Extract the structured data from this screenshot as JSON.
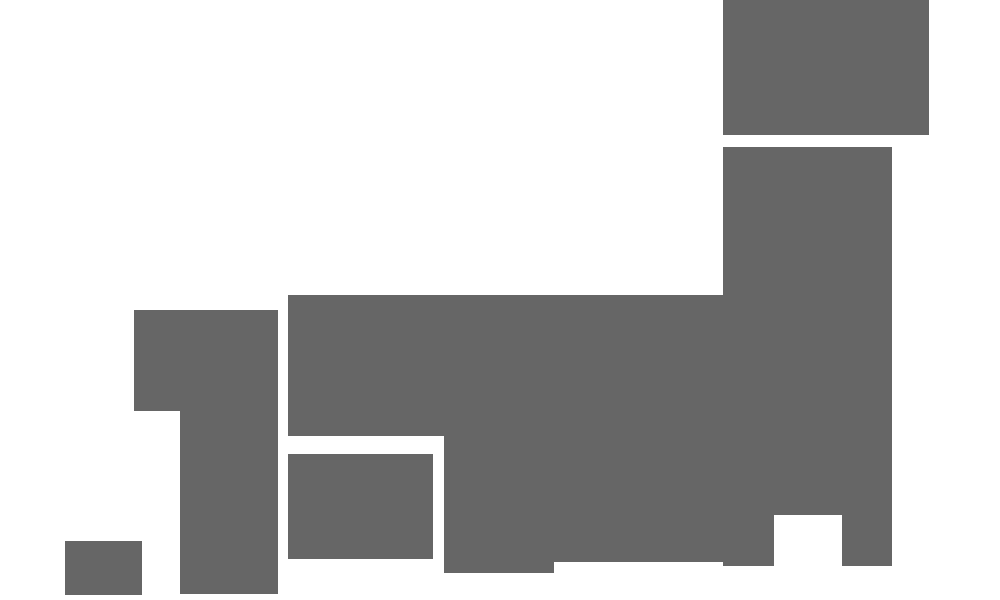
{
  "canvas": {
    "width": 1000,
    "height": 600,
    "background": "#ffffff"
  },
  "map": {
    "description": "low-resolution blocky silhouette of Japan, gray blocks on white",
    "block_color": "#666666",
    "blocks": [
      {
        "name": "map-block-hokkaido",
        "x": 723,
        "y": 0,
        "w": 206,
        "h": 135
      },
      {
        "name": "map-block-tohoku-kanto",
        "x": 723,
        "y": 147,
        "w": 169,
        "h": 368
      },
      {
        "name": "map-block-izu-stub",
        "x": 723,
        "y": 515,
        "w": 51,
        "h": 51
      },
      {
        "name": "map-block-boso-stub",
        "x": 842,
        "y": 515,
        "w": 50,
        "h": 51
      },
      {
        "name": "map-block-central-honshu",
        "x": 288,
        "y": 295,
        "w": 435,
        "h": 141
      },
      {
        "name": "map-block-chubu-south",
        "x": 444,
        "y": 436,
        "w": 110,
        "h": 137
      },
      {
        "name": "map-block-tokai",
        "x": 554,
        "y": 436,
        "w": 169,
        "h": 126
      },
      {
        "name": "map-block-chugoku",
        "x": 134,
        "y": 310,
        "w": 144,
        "h": 101
      },
      {
        "name": "map-block-kyushu",
        "x": 180,
        "y": 411,
        "w": 98,
        "h": 183
      },
      {
        "name": "map-block-shikoku",
        "x": 288,
        "y": 454,
        "w": 145,
        "h": 105
      },
      {
        "name": "map-block-southwest-island",
        "x": 65,
        "y": 541,
        "w": 77,
        "h": 54
      }
    ]
  }
}
